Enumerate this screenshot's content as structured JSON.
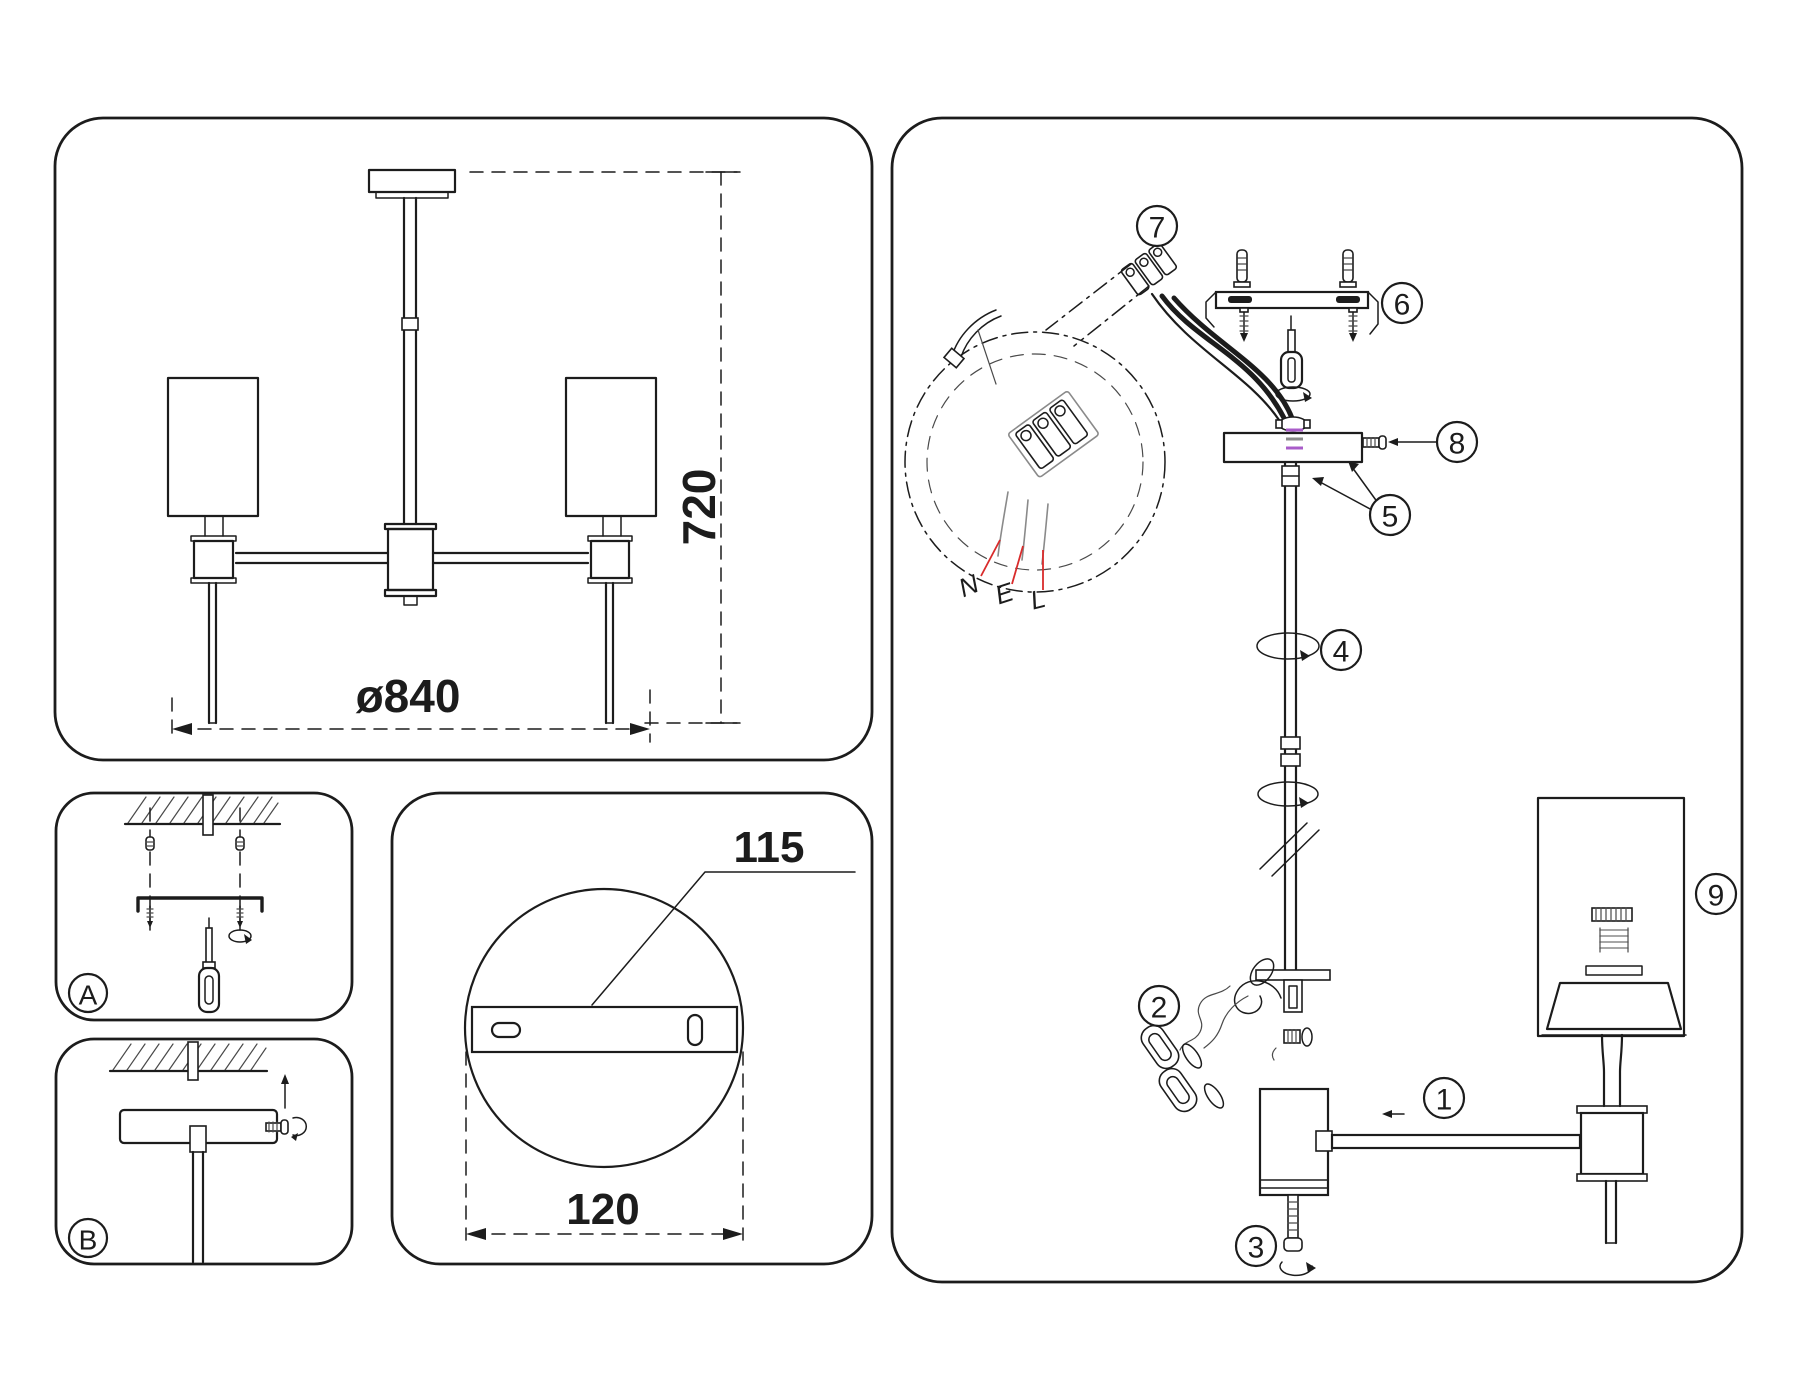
{
  "dimensions": {
    "fixture_height": "720",
    "fixture_diameter": "ø840",
    "plate_hole_spacing": "115",
    "plate_width": "120"
  },
  "step_labels": {
    "a": "A",
    "b": "B"
  },
  "callouts": {
    "1": "1",
    "2": "2",
    "3": "3",
    "4": "4",
    "5": "5",
    "6": "6",
    "7": "7",
    "8": "8",
    "9": "9"
  },
  "wiring_labels": {
    "neutral": "N",
    "earth": "E",
    "live": "L"
  },
  "colors": {
    "line": "#1c1c1c",
    "wire_leader_red": "#d92b2b",
    "canopy_accent_purple": "#a95cc9",
    "canopy_accent_gray": "#8a8a8a"
  }
}
